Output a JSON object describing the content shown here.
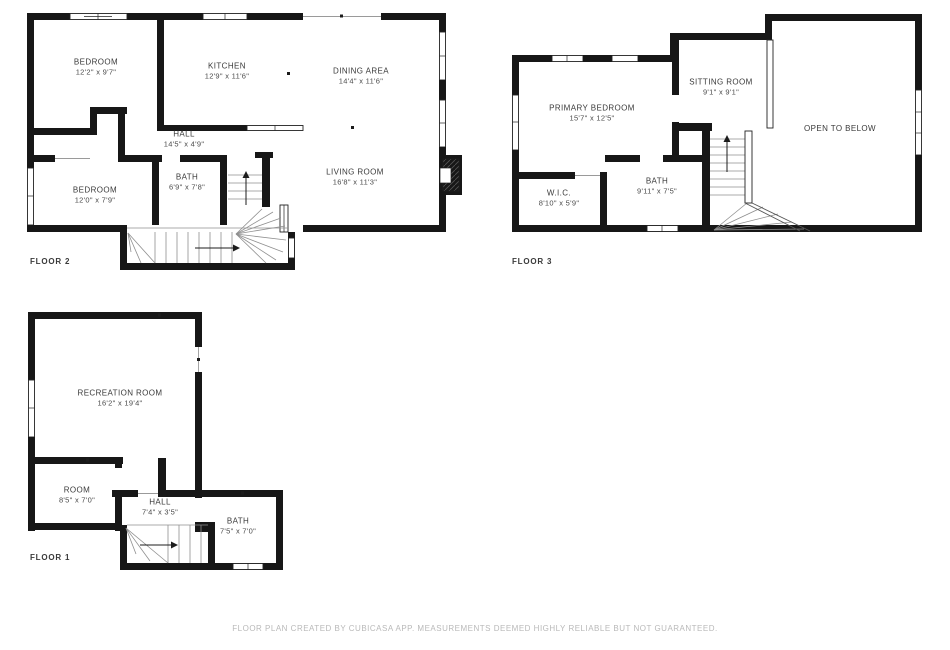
{
  "page": {
    "background": "#ffffff",
    "wall_color": "#171717",
    "label_color": "#3a3a3a",
    "footer_color": "#b9b9b9"
  },
  "footer": {
    "text": "FLOOR PLAN CREATED BY CUBICASA APP. MEASUREMENTS DEEMED HIGHLY RELIABLE BUT NOT GUARANTEED."
  },
  "floors": [
    {
      "label": "FLOOR 2",
      "rooms": [
        {
          "name": "BEDROOM",
          "dims": "12'2\" x 9'7\""
        },
        {
          "name": "KITCHEN",
          "dims": "12'9\" x 11'6\""
        },
        {
          "name": "DINING AREA",
          "dims": "14'4\" x 11'6\""
        },
        {
          "name": "HALL",
          "dims": "14'5\" x 4'9\""
        },
        {
          "name": "BATH",
          "dims": "6'9\" x 7'8\""
        },
        {
          "name": "BEDROOM",
          "dims": "12'0\" x 7'9\""
        },
        {
          "name": "LIVING ROOM",
          "dims": "16'8\" x 11'3\""
        }
      ]
    },
    {
      "label": "FLOOR 3",
      "rooms": [
        {
          "name": "PRIMARY BEDROOM",
          "dims": "15'7\" x 12'5\""
        },
        {
          "name": "SITTING ROOM",
          "dims": "9'1\" x 9'1\""
        },
        {
          "name": "OPEN TO BELOW",
          "dims": ""
        },
        {
          "name": "W.I.C.",
          "dims": "8'10\" x 5'9\""
        },
        {
          "name": "BATH",
          "dims": "9'11\" x 7'5\""
        }
      ]
    },
    {
      "label": "FLOOR 1",
      "rooms": [
        {
          "name": "RECREATION ROOM",
          "dims": "16'2\" x 19'4\""
        },
        {
          "name": "ROOM",
          "dims": "8'5\" x 7'0\""
        },
        {
          "name": "HALL",
          "dims": "7'4\" x 3'5\""
        },
        {
          "name": "BATH",
          "dims": "7'5\" x 7'0\""
        }
      ]
    }
  ]
}
